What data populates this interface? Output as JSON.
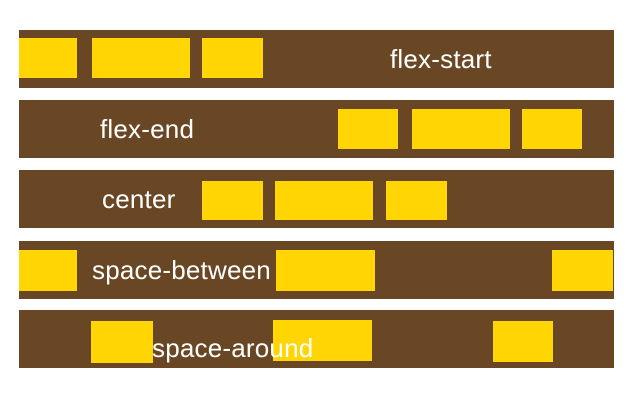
{
  "colors": {
    "background": "#ffffff",
    "container_bar": "#6a4724",
    "flex_item": "#ffd504",
    "label_text": "#ffffff"
  },
  "diagram": {
    "description": "justify-content flexbox alignment illustration",
    "rows": [
      {
        "label": "flex-start",
        "bar": {
          "x": 19,
          "y": 30,
          "w": 595,
          "h": 58
        },
        "label_pos": {
          "x": 390,
          "dy": 0
        },
        "boxes": [
          {
            "x": 19,
            "y": 38,
            "w": 58,
            "h": 40
          },
          {
            "x": 92,
            "y": 38,
            "w": 98,
            "h": 40
          },
          {
            "x": 202,
            "y": 38,
            "w": 61,
            "h": 40
          }
        ]
      },
      {
        "label": "flex-end",
        "bar": {
          "x": 19,
          "y": 100,
          "w": 595,
          "h": 58
        },
        "label_pos": {
          "x": 100,
          "dy": 0
        },
        "boxes": [
          {
            "x": 338,
            "y": 109,
            "w": 60,
            "h": 40
          },
          {
            "x": 412,
            "y": 109,
            "w": 98,
            "h": 40
          },
          {
            "x": 522,
            "y": 109,
            "w": 60,
            "h": 40
          }
        ]
      },
      {
        "label": "center",
        "bar": {
          "x": 19,
          "y": 170,
          "w": 595,
          "h": 58
        },
        "label_pos": {
          "x": 102,
          "dy": 0
        },
        "boxes": [
          {
            "x": 202,
            "y": 181,
            "w": 61,
            "h": 39
          },
          {
            "x": 275,
            "y": 181,
            "w": 98,
            "h": 39
          },
          {
            "x": 386,
            "y": 181,
            "w": 61,
            "h": 39
          }
        ]
      },
      {
        "label": "space-between",
        "bar": {
          "x": 19,
          "y": 241,
          "w": 595,
          "h": 58
        },
        "label_pos": {
          "x": 92,
          "dy": 0
        },
        "boxes": [
          {
            "x": 19,
            "y": 250,
            "w": 58,
            "h": 41
          },
          {
            "x": 276,
            "y": 250,
            "w": 99,
            "h": 41
          },
          {
            "x": 552,
            "y": 250,
            "w": 61,
            "h": 41
          }
        ]
      },
      {
        "label": "space-around",
        "bar": {
          "x": 19,
          "y": 310,
          "w": 595,
          "h": 58
        },
        "label_pos": {
          "x": 152,
          "dy": 9
        },
        "boxes": [
          {
            "x": 91,
            "y": 321,
            "w": 62,
            "h": 42
          },
          {
            "x": 273,
            "y": 320,
            "w": 99,
            "h": 41
          },
          {
            "x": 493,
            "y": 321,
            "w": 60,
            "h": 41
          }
        ]
      }
    ]
  }
}
